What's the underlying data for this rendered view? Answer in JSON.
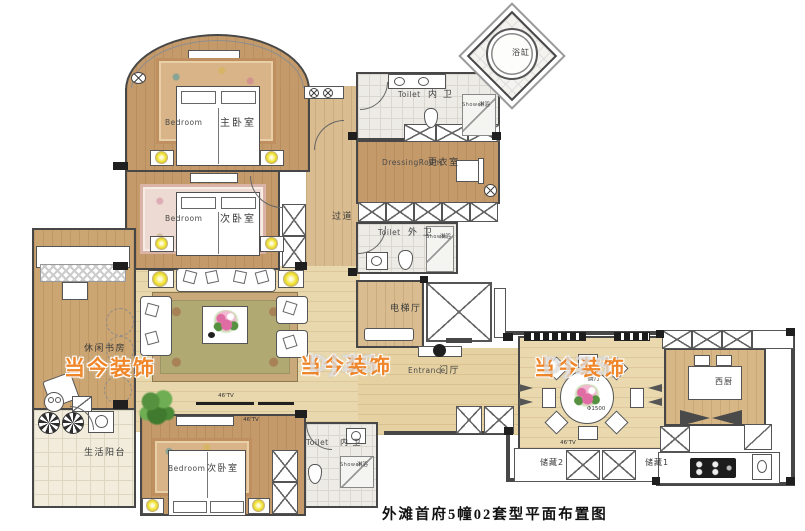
{
  "title": "外滩首府5幢02套型平面布置图",
  "watermark": {
    "text": "当今装饰",
    "ghost": "DJZS"
  },
  "tv_label": "46'TV",
  "rooms": {
    "master_bedroom": {
      "cn": "主卧室",
      "en": "Bedroom"
    },
    "second_bedroom": {
      "cn": "次卧室",
      "en": "Bedroom"
    },
    "third_bedroom": {
      "cn": "次卧室",
      "en": "Bedroom"
    },
    "master_toilet": {
      "cn": "内 卫",
      "en": "Toilet"
    },
    "third_toilet": {
      "cn": "内 卫",
      "en": "Toilet"
    },
    "guest_toilet": {
      "cn": "外 卫",
      "en": "Toilet"
    },
    "dressing_room": {
      "cn": "更衣室",
      "en": "DressingRoom"
    },
    "corridor": {
      "cn": "过道"
    },
    "elevator_hall": {
      "cn": "电梯厅"
    },
    "entrance": {
      "cn": "门厅",
      "en": "Entrance"
    },
    "dining_room": {
      "cn": "餐厅",
      "table_diameter": "Φ1500"
    },
    "west_kitchen": {
      "cn": "西厨"
    },
    "study": {
      "cn": "休闲书房"
    },
    "balcony": {
      "cn": "生活阳台"
    },
    "storage_1": {
      "cn": "储藏1"
    },
    "storage_2": {
      "cn": "储藏2"
    },
    "bathtub": {
      "cn": "浴缸"
    },
    "shower": {
      "cn": "淋浴",
      "en": "Shower"
    }
  },
  "colors": {
    "wall": "#474747",
    "dark": "#1f1f1f",
    "wood": "#c49a6b",
    "wood2": "#d9bd90",
    "light": "#e9d8ae",
    "light2": "#e5d1a1",
    "dining": "#ead9af",
    "kitchen": "#d7b786",
    "study": "#cba572",
    "tile": "#ecebe6",
    "balcony": "#f1ecdc",
    "cpt_tan": "#d8b488",
    "cpt_tan_bd": "#c08f60",
    "cpt_pink": "#eddbd3",
    "cpt_pink_bd": "#d8b3a6",
    "cpt_olive": "#b0a972",
    "cpt_olive_bd": "#c9a87a",
    "lamp": "#f2e63b",
    "watermark": "#f0862a",
    "flower": "#e06ca4",
    "plant": "#55913f"
  }
}
